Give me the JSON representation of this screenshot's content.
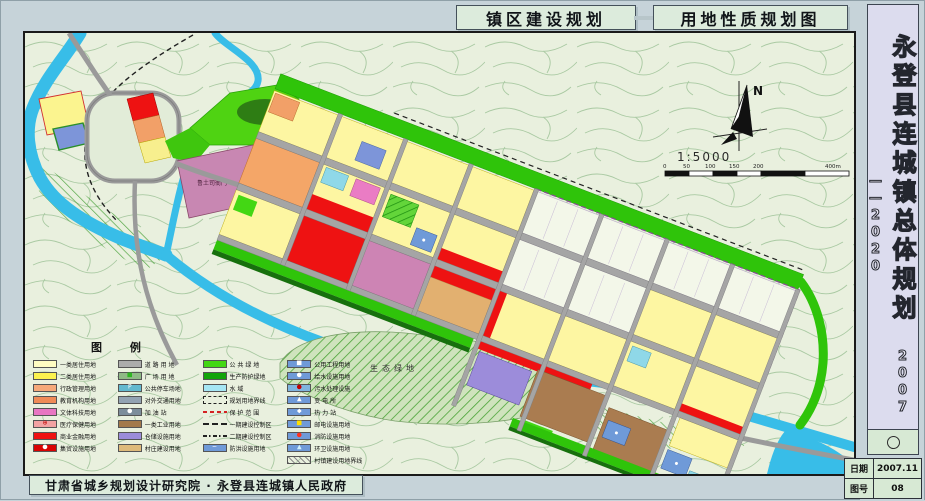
{
  "titles": {
    "left": "镇区建设规划",
    "right": "用地性质规划图"
  },
  "sidebar": {
    "title": "永登县连城镇总体规划",
    "years": "2007——2020",
    "date_label": "日期",
    "date_value": "2007.11",
    "sheet_label": "图号",
    "sheet_value": "08"
  },
  "footer": {
    "credit": "甘肃省城乡规划设计研究院 · 永登县连城镇人民政府"
  },
  "map": {
    "north_label": "N",
    "scale_text": "1:5000",
    "scale_ticks": [
      "0",
      "50",
      "100",
      "150",
      "200",
      "400m"
    ],
    "labels": {
      "eco": "生态绿地",
      "landmark": "鲁土司衙门"
    }
  },
  "colors": {
    "canvas_bg": "#c6d3d9",
    "panel_bg": "#dcebdc",
    "sidebar_bg": "#dcdcee",
    "map_bg": "#e9f0de",
    "contour": "#a9c9a2",
    "river": "#38bde8",
    "green_belt": "#2fc40a",
    "forest": "#2e7d14",
    "road": "#a5a5a5",
    "residential": "#fdf6a2",
    "commercial": "#ee1212",
    "culture": "#cd84b4",
    "education": "#f4a668",
    "industry": "#aa7c50",
    "warehouse": "#9c8cda",
    "utility": "#6f9ad8"
  },
  "legend": {
    "title": "图 例",
    "columns": [
      {
        "items": [
          {
            "label": "一类居住用地",
            "type": "fill",
            "color": "#FFFCC2"
          },
          {
            "label": "二类居住用地",
            "type": "fill",
            "color": "#FCF24F"
          },
          {
            "label": "行政管理用地",
            "type": "fill",
            "color": "#F6A97A"
          },
          {
            "label": "教育机构用地",
            "type": "fill",
            "color": "#EF8B57"
          },
          {
            "label": "文体科技用地",
            "type": "fill",
            "color": "#E876C2"
          },
          {
            "label": "医疗保健用地",
            "type": "fill",
            "color": "#F2A3A3",
            "symbol": "⊕",
            "symbolColor": "#c00000"
          },
          {
            "label": "商业金融用地",
            "type": "fill",
            "color": "#EE1212"
          },
          {
            "label": "集贸设施用地",
            "type": "fill",
            "color": "#D90303",
            "symbol": "●",
            "symbolColor": "#ffffff"
          }
        ]
      },
      {
        "items": [
          {
            "label": "道 路 用 地",
            "type": "fill",
            "color": "#ACACAC"
          },
          {
            "label": "广 场 用 地",
            "type": "fill",
            "color": "#8FBA86",
            "symbol": "■",
            "symbolColor": "#2fb522"
          },
          {
            "label": "公共停车场地",
            "type": "fill",
            "color": "#63B9CF",
            "symbol": "P",
            "symbolColor": "#ffffff"
          },
          {
            "label": "对外交通用地",
            "type": "fill",
            "color": "#93A3B3"
          },
          {
            "label": "加 油 站",
            "type": "fill",
            "color": "#7C8D9B",
            "symbol": "●",
            "symbolColor": "#ffffff"
          },
          {
            "label": "一类工业用地",
            "type": "fill",
            "color": "#A3794B"
          },
          {
            "label": "仓储设施用地",
            "type": "fill",
            "color": "#9C8CDA"
          },
          {
            "label": "村庄建设用地",
            "type": "fill",
            "color": "#DEBA7B"
          }
        ]
      },
      {
        "items": [
          {
            "label": "公 共 绿 地",
            "type": "fill",
            "color": "#43D714"
          },
          {
            "label": "生产防护绿地",
            "type": "fill",
            "color": "#12A40A"
          },
          {
            "label": "水 域",
            "type": "fill",
            "color": "#A5E6F4"
          },
          {
            "label": "规划用地界线",
            "type": "dash-black"
          },
          {
            "label": "保 护 范 围",
            "type": "dash-red"
          },
          {
            "label": "一期建设控制区",
            "type": "dash-long"
          },
          {
            "label": "二期建设控制区",
            "type": "dash-dot"
          },
          {
            "label": "防洪设施用地",
            "type": "fill",
            "color": "#6F9AD8",
            "symbol": "~",
            "symbolColor": "#ffffff"
          }
        ]
      },
      {
        "items": [
          {
            "label": "公用工程用地",
            "type": "fill",
            "color": "#6F9AD8",
            "symbol": "■",
            "symbolColor": "#ffffff"
          },
          {
            "label": "给水设施用地",
            "type": "fill",
            "color": "#6F9AD8",
            "symbol": "●",
            "symbolColor": "#ffffff"
          },
          {
            "label": "污水处理设施",
            "type": "fill",
            "color": "#7FB4DE",
            "symbol": "●",
            "symbolColor": "#c00000"
          },
          {
            "label": "变 电 所",
            "type": "fill",
            "color": "#6F9AD8",
            "symbol": "▲",
            "symbolColor": "#ffffff"
          },
          {
            "label": "热 力 站",
            "type": "fill",
            "color": "#6F9AD8",
            "symbol": "◆",
            "symbolColor": "#ffffff"
          },
          {
            "label": "邮电设施用地",
            "type": "fill",
            "color": "#6F9AD8",
            "symbol": "■",
            "symbolColor": "#ffe000"
          },
          {
            "label": "消防设施用地",
            "type": "fill",
            "color": "#6F9AD8",
            "symbol": "●",
            "symbolColor": "#ff3020"
          },
          {
            "label": "环卫设施用地",
            "type": "fill",
            "color": "#6F9AD8",
            "symbol": "▲",
            "symbolColor": "#d0f0ff"
          },
          {
            "label": "村镇建设用地界线",
            "type": "hatch"
          }
        ]
      }
    ]
  }
}
